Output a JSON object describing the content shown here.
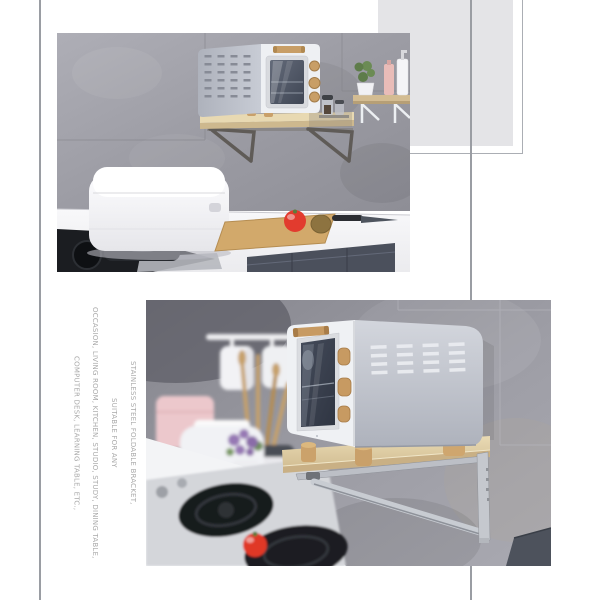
{
  "page": {
    "background_color": "#ffffff"
  },
  "decor": {
    "left_line_color": "#9a9da3",
    "right_line_color": "#9a9da3",
    "square_fill_color": "#e4e4e7",
    "square_outline_color": "#abaeb4"
  },
  "marketing_text": {
    "color": "#a9a9a9",
    "lines": [
      "STAINLESS STEEL FOLDABLE BRACKET,",
      "SUITABLE FOR ANY",
      "OCCASION, LIVING ROOM, KITCHEN, STUDIO, STUDY, DINING TABLE,",
      "COMPUTER DESK, LEARNING TABLE, ETC.,"
    ]
  },
  "photos": {
    "top_photo": {
      "alt": "Toaster oven on wall-mounted wooden bracket shelf above kitchen counter with rice cooker, cutting board, tomato, kiwi and knife"
    },
    "bottom_photo": {
      "alt": "Close-up of toaster oven standing on foldable stainless steel wall bracket shelf above a gas stove with tomato on counter"
    }
  }
}
